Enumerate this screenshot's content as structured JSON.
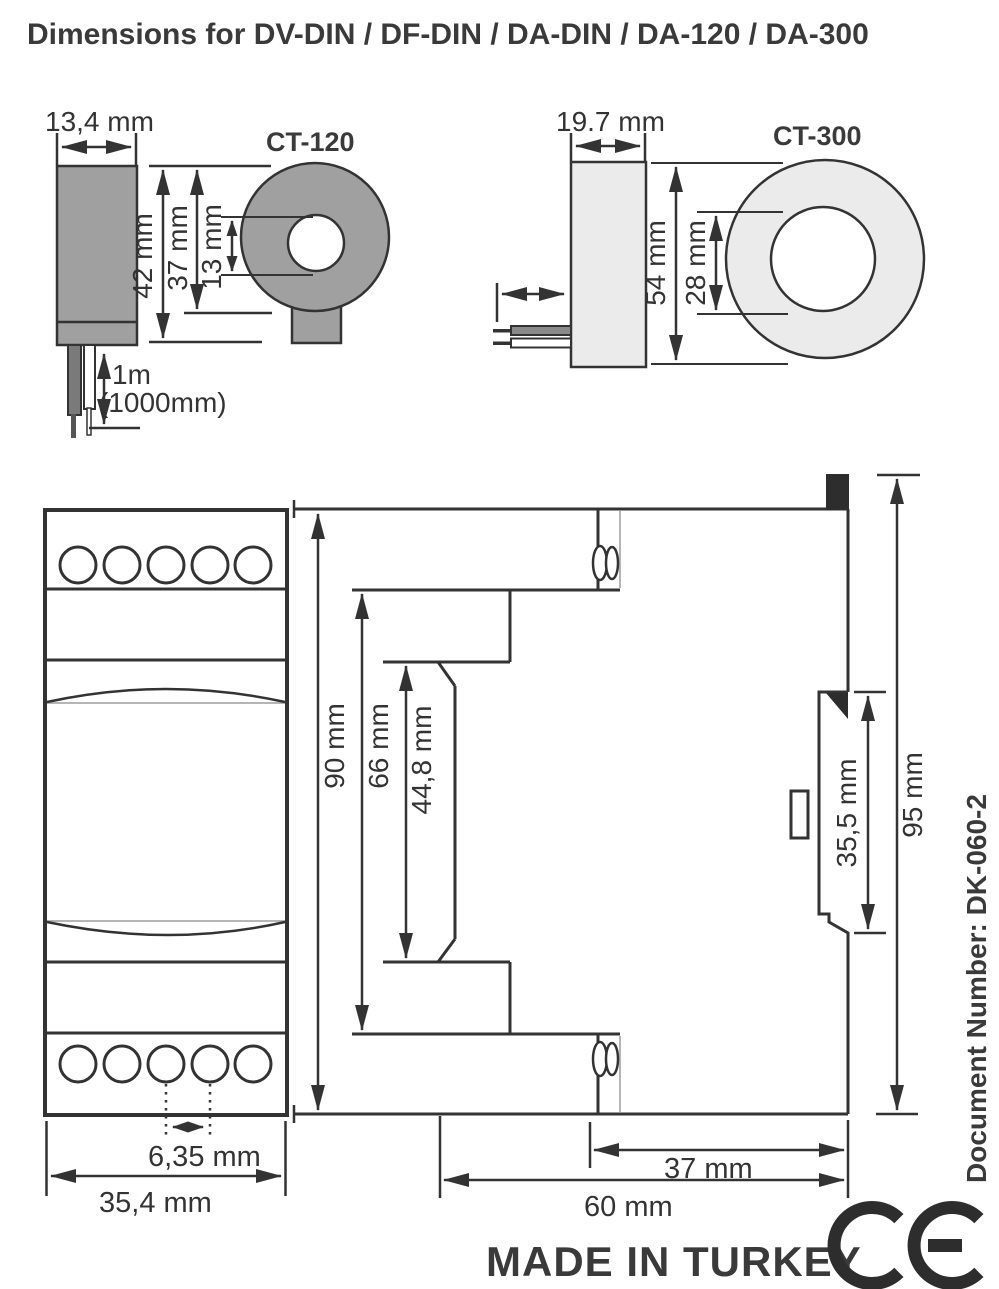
{
  "title": "Dimensions for DV-DIN / DF-DIN / DA-DIN / DA-120 / DA-300",
  "ct120": {
    "label": "CT-120",
    "width": "13,4 mm",
    "height": "42 mm",
    "outer_diameter": "37 mm",
    "hole_diameter": "13 mm",
    "cable_length": "1m",
    "cable_length_alt": "(1000mm)"
  },
  "ct300": {
    "label": "CT-300",
    "width": "19.7 mm",
    "outer_diameter": "54 mm",
    "hole_diameter": "28 mm"
  },
  "module": {
    "front_height": "90 mm",
    "front_width": "35,4 mm",
    "terminal_pitch": "6,35 mm",
    "side_upper_height": "66 mm",
    "side_face_height": "44,8 mm",
    "rail_recess_height": "35,5 mm",
    "total_height": "95 mm",
    "rear_depth": "37 mm",
    "total_depth": "60 mm"
  },
  "footer": {
    "made_in": "MADE IN TURKEY",
    "ce_mark": "CE",
    "document_number": "Document Number: DK-060-2"
  },
  "colors": {
    "line": "#333333",
    "text": "#3a3a3a",
    "ct120_fill": "#a0a0a0",
    "ct300_fill": "#ebebeb",
    "wire_dark": "#7a7a7a",
    "clip_black": "#2d2d2d",
    "light_edge": "#b5b5b5"
  }
}
